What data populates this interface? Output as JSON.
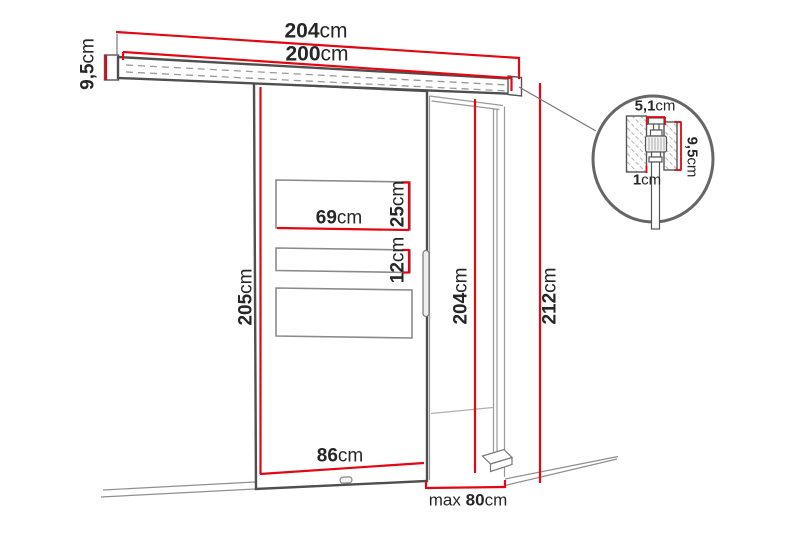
{
  "diagram": {
    "name": "sliding-door-dimension-diagram",
    "units": "cm"
  },
  "colors": {
    "dimension_red": "#e30613",
    "outline_dark": "#4f4f4f",
    "line_gray": "#8f8f8f",
    "text": "#262626",
    "detail_circle": "#666666"
  },
  "dims": {
    "rail_total": {
      "value": "204",
      "unit": "cm"
    },
    "rail_track": {
      "value": "200",
      "unit": "cm"
    },
    "rail_height": {
      "value": "9,5",
      "unit": "cm"
    },
    "door_height": {
      "value": "205",
      "unit": "cm"
    },
    "panel_width": {
      "value": "69",
      "unit": "cm"
    },
    "panel_top_h": {
      "value": "25",
      "unit": "cm"
    },
    "panel_mid_h": {
      "value": "12",
      "unit": "cm"
    },
    "door_width": {
      "value": "86",
      "unit": "cm"
    },
    "opening_height": {
      "value": "204",
      "unit": "cm"
    },
    "total_height": {
      "value": "212",
      "unit": "cm"
    },
    "opening_width": {
      "prefix": "max",
      "value": "80",
      "unit": "cm"
    },
    "detail_width": {
      "value": "5,1",
      "unit": "cm"
    },
    "detail_height": {
      "value": "9,5",
      "unit": "cm"
    },
    "detail_gap": {
      "value": "1",
      "unit": "cm"
    }
  }
}
